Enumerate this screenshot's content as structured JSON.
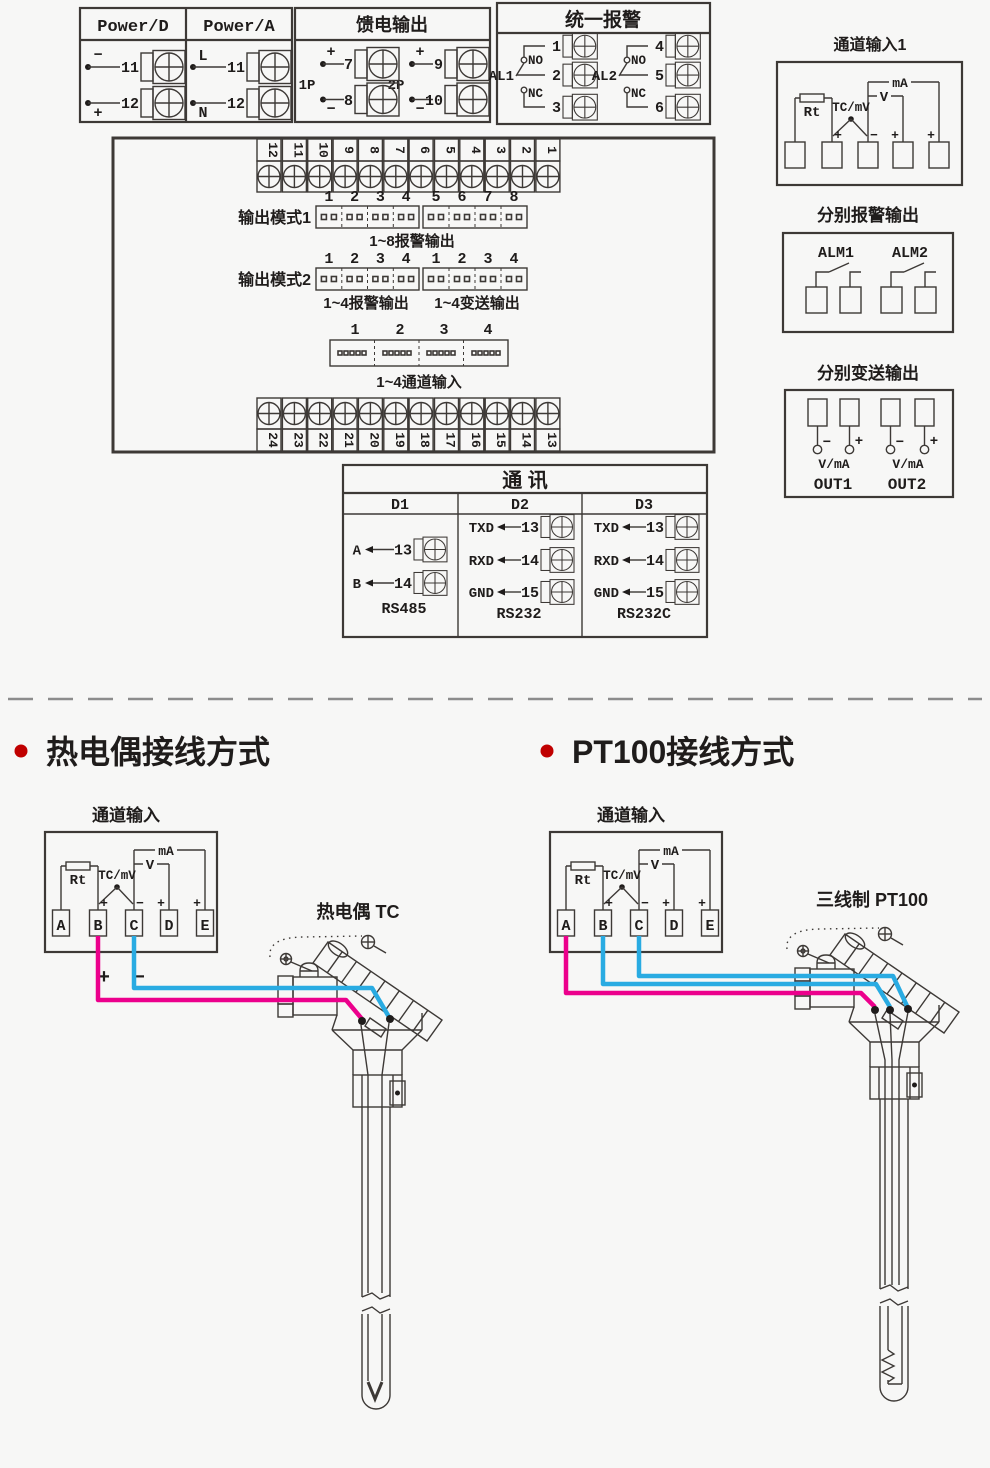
{
  "colors": {
    "wire_pink": "#ec008c",
    "wire_blue": "#29abe2",
    "bullet_red": "#c00000",
    "line": "#3d3936"
  },
  "power": {
    "title_d": "Power/D",
    "title_a": "Power/A",
    "d_rows": [
      {
        "sign": "−",
        "num": "11"
      },
      {
        "sign": "+",
        "num": "12"
      }
    ],
    "a_rows": [
      {
        "sign": "L",
        "num": "11"
      },
      {
        "sign": "N",
        "num": "12"
      }
    ]
  },
  "feed": {
    "title": "馈电输出",
    "g1_label": "1P",
    "g2_label": "2P",
    "g1_rows": [
      {
        "sign": "+",
        "num": "7"
      },
      {
        "sign": "−",
        "num": "8"
      }
    ],
    "g2_rows": [
      {
        "sign": "+",
        "num": "9"
      },
      {
        "sign": "−",
        "num": "10"
      }
    ]
  },
  "alarm": {
    "title": "统一报警",
    "g1": {
      "label": "AL1",
      "no": "NO",
      "nc": "NC",
      "nums": [
        "1",
        "2",
        "3"
      ]
    },
    "g2": {
      "label": "AL2",
      "no": "NO",
      "nc": "NC",
      "nums": [
        "4",
        "5",
        "6"
      ]
    }
  },
  "ch1": {
    "title": "通道输入1"
  },
  "chbox": {
    "rt": "Rt",
    "tc": "TC/mV",
    "v": "V",
    "ma": "mA",
    "p1": "+",
    "m1": "−",
    "p2": "+",
    "p3": "+"
  },
  "panel": {
    "top_strip": [
      "12",
      "11",
      "10",
      "9",
      "8",
      "7",
      "6",
      "5",
      "4",
      "3",
      "2",
      "1"
    ],
    "bottom_strip": [
      "24",
      "23",
      "22",
      "21",
      "20",
      "19",
      "18",
      "17",
      "16",
      "15",
      "14",
      "13"
    ],
    "mode1": {
      "label": "输出模式1",
      "nums": [
        "1",
        "2",
        "3",
        "4",
        "5",
        "6",
        "7",
        "8"
      ],
      "caption": "1~8报警输出"
    },
    "mode2": {
      "label": "输出模式2",
      "nums": [
        "1",
        "2",
        "3",
        "4",
        "1",
        "2",
        "3",
        "4"
      ],
      "caption_left": "1~4报警输出",
      "caption_right": "1~4变送输出"
    },
    "chconn": {
      "nums": [
        "1",
        "2",
        "3",
        "4"
      ],
      "caption": "1~4通道输入"
    }
  },
  "comm": {
    "title": "通  讯",
    "cols": [
      {
        "name": "D1",
        "std": "RS485",
        "rows": [
          {
            "label": "A",
            "num": "13"
          },
          {
            "label": "B",
            "num": "14"
          }
        ]
      },
      {
        "name": "D2",
        "std": "RS232",
        "rows": [
          {
            "label": "TXD",
            "num": "13"
          },
          {
            "label": "RXD",
            "num": "14"
          },
          {
            "label": "GND",
            "num": "15"
          }
        ]
      },
      {
        "name": "D3",
        "std": "RS232C",
        "rows": [
          {
            "label": "TXD",
            "num": "13"
          },
          {
            "label": "RXD",
            "num": "14"
          },
          {
            "label": "GND",
            "num": "15"
          }
        ]
      }
    ]
  },
  "alarm_out": {
    "title": "分别报警输出",
    "alm1": "ALM1",
    "alm2": "ALM2"
  },
  "trans_out": {
    "title": "分别变送输出",
    "s1": "−",
    "s2": "+",
    "s3": "−",
    "s4": "+",
    "vma1": "V/mA",
    "vma2": "V/mA",
    "out1": "OUT1",
    "out2": "OUT2"
  },
  "sections": {
    "tc": "热电偶接线方式",
    "pt": "PT100接线方式"
  },
  "tc_diag": {
    "title": "通道输入",
    "letters": [
      "A",
      "B",
      "C",
      "D",
      "E"
    ],
    "plus": "+",
    "minus": "−",
    "probe": "热电偶 TC"
  },
  "pt_diag": {
    "title": "通道输入",
    "letters": [
      "A",
      "B",
      "C",
      "D",
      "E"
    ],
    "probe": "三线制 PT100"
  }
}
